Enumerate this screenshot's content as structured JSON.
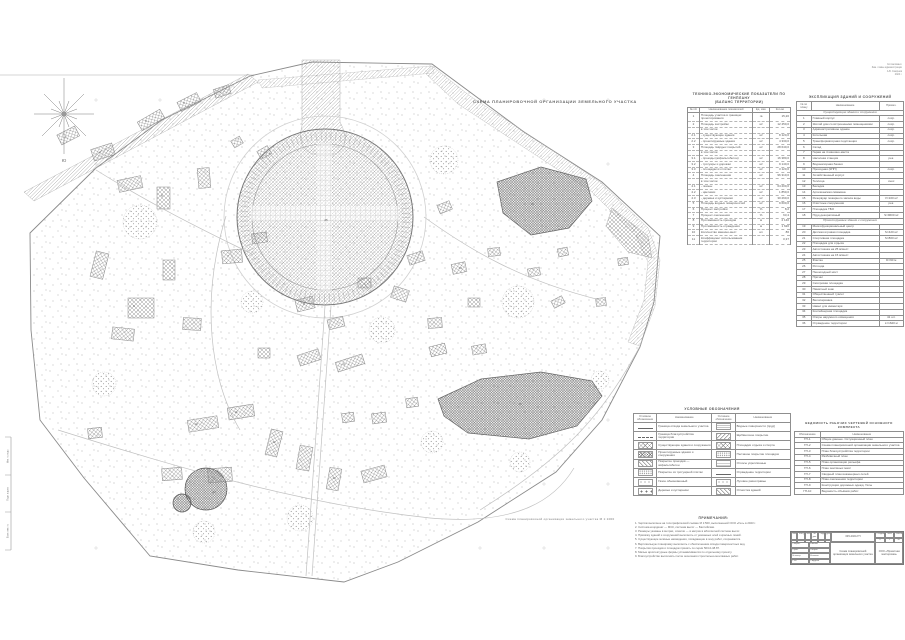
{
  "plan": {
    "title": "СХЕМА ПЛАНИРОВОЧНОЙ ОРГАНИЗАЦИИ ЗЕМЕЛЬНОГО УЧАСТКА",
    "caption": "Схема планировочной организации земельного участка  М 1:1000",
    "compass_south_label": "Ю",
    "corner_note_lines": [
      "Согласовано:",
      "Зам. главы администрации",
      "А.В. Смирнов",
      "2024 г."
    ],
    "labels": [
      {
        "x": 66,
        "y": 137,
        "t": "1"
      },
      {
        "x": 100,
        "y": 152,
        "t": "2"
      },
      {
        "x": 146,
        "y": 121,
        "t": "3"
      },
      {
        "x": 184,
        "y": 103,
        "t": "4"
      },
      {
        "x": 162,
        "y": 196,
        "t": "5"
      },
      {
        "x": 134,
        "y": 306,
        "t": "6"
      },
      {
        "x": 228,
        "y": 256,
        "t": "7"
      },
      {
        "x": 304,
        "y": 304,
        "t": "8"
      },
      {
        "x": 344,
        "y": 364,
        "t": "9"
      },
      {
        "x": 196,
        "y": 424,
        "t": "10"
      },
      {
        "x": 236,
        "y": 412,
        "t": "11"
      },
      {
        "x": 274,
        "y": 442,
        "t": "12"
      },
      {
        "x": 334,
        "y": 478,
        "t": "13"
      },
      {
        "x": 460,
        "y": 268,
        "t": "14"
      },
      {
        "x": 532,
        "y": 204,
        "t": "15"
      },
      {
        "x": 520,
        "y": 404,
        "t": "19"
      },
      {
        "x": 214,
        "y": 492,
        "t": "20"
      },
      {
        "x": 326,
        "y": 220,
        "t": "25"
      }
    ]
  },
  "tep_table": {
    "title_line1": "ТЕХНИКО-ЭКОНОМИЧЕСКИЕ ПОКАЗАТЕЛИ ПО ГЕНПЛАНУ",
    "title_line2": "(БАЛАНС ТЕРРИТОРИИ)",
    "columns": [
      "№ п/п",
      "Наименование показателей",
      "Ед. изм.",
      "Кол-во"
    ],
    "rows": [
      [
        "1",
        "Площадь участка в границах проектирования",
        "га",
        "15,20"
      ],
      [
        "2",
        "Площадь застройки",
        "м²",
        "12 450,0"
      ],
      [
        "",
        "в том числе:",
        "",
        ""
      ],
      [
        "2.1",
        "- существующие здания",
        "м²",
        "8 120,0"
      ],
      [
        "2.2",
        "- проектируемые здания",
        "м²",
        "4 330,0"
      ],
      [
        "3",
        "Площадь твёрдых покрытий",
        "м²",
        "28 640,0"
      ],
      [
        "",
        "в том числе:",
        "",
        ""
      ],
      [
        "3.1",
        "- проезды (асфальтобетон)",
        "м²",
        "16 380,0"
      ],
      [
        "3.2",
        "- тротуары и дорожки",
        "м²",
        "9 140,0"
      ],
      [
        "3.3",
        "- площадки из плитки",
        "м²",
        "3 120,0"
      ],
      [
        "4",
        "Площадь озеленения",
        "м²",
        "96 310,0"
      ],
      [
        "",
        "в том числе:",
        "",
        ""
      ],
      [
        "4.1",
        "- газоны",
        "м²",
        "64 200,0"
      ],
      [
        "4.2",
        "- цветники",
        "м²",
        "1 850,0"
      ],
      [
        "4.3",
        "- деревья и кустарники",
        "м²",
        "30 260,0"
      ],
      [
        "5",
        "Площадь водных поверхностей",
        "м²",
        "9 600,0"
      ],
      [
        "6",
        "Процент застройки",
        "%",
        "8,2"
      ],
      [
        "7",
        "Процент озеленения",
        "%",
        "63,4"
      ],
      [
        "8",
        "Протяжённость проездов",
        "м",
        "2 140"
      ],
      [
        "9",
        "Протяжённость ограждения",
        "м",
        "1 620"
      ],
      [
        "10",
        "Количество машино-мест",
        "шт.",
        "86"
      ],
      [
        "11",
        "Коэффициент использования территории",
        "",
        "0,37"
      ]
    ]
  },
  "explication_table": {
    "title": "ЭКСПЛИКАЦИЯ ЗДАНИЙ И СООРУЖЕНИЙ",
    "columns": [
      "№ по плану",
      "Наименование",
      "Примеч."
    ],
    "sections": [
      {
        "header": "Существующие здания и сооружения",
        "rows": [
          [
            "1",
            "Главный корпус",
            "сохр."
          ],
          [
            "2",
            "Жилой дом со встроенными помещениями",
            "сохр."
          ],
          [
            "3",
            "Административное здание",
            "сохр."
          ],
          [
            "4",
            "Котельная",
            "сохр."
          ],
          [
            "5",
            "Трансформаторная подстанция",
            "сохр."
          ],
          [
            "6",
            "Склад",
            ""
          ],
          [
            "7",
            "Гараж на 4 машино-места",
            ""
          ],
          [
            "8",
            "Насосная станция",
            "рек."
          ],
          [
            "9",
            "Водонапорная башня",
            ""
          ],
          [
            "10",
            "Проходная (КПП)",
            "сохр."
          ],
          [
            "11",
            "Хозяйственный корпус",
            ""
          ],
          [
            "12",
            "Теплица",
            "снос"
          ],
          [
            "13",
            "Беседка",
            ""
          ],
          [
            "14",
            "Артезианская скважина",
            ""
          ],
          [
            "15",
            "Резервуар пожарного запаса воды",
            "V=100 м³"
          ],
          [
            "16",
            "Очистные сооружения",
            "рек."
          ],
          [
            "17",
            "Площадка ТБО",
            ""
          ],
          [
            "18",
            "Пруд декоративный",
            "S=9600 м²"
          ]
        ]
      },
      {
        "header": "Проектируемые здания и сооружения",
        "rows": [
          [
            "19",
            "Многофункциональный центр",
            ""
          ],
          [
            "20",
            "Детская игровая площадка",
            "S=420 м²"
          ],
          [
            "21",
            "Спортивная площадка",
            "S=800 м²"
          ],
          [
            "22",
            "Площадка для отдыха",
            ""
          ],
          [
            "23",
            "Автостоянка на 25 м/мест",
            ""
          ],
          [
            "24",
            "Автостоянка на 15 м/мест",
            ""
          ],
          [
            "25",
            "Фонтан",
            "D=90 м"
          ],
          [
            "26",
            "Ротонда",
            ""
          ],
          [
            "27",
            "Пешеходный мост",
            ""
          ],
          [
            "28",
            "Причал",
            ""
          ],
          [
            "29",
            "Смотровая площадка",
            ""
          ],
          [
            "30",
            "Памятный знак",
            ""
          ],
          [
            "31",
            "Общественный туалет",
            ""
          ],
          [
            "32",
            "Велопарковка",
            ""
          ],
          [
            "33",
            "Навес для инвентаря",
            ""
          ],
          [
            "34",
            "Контейнерная площадка",
            ""
          ],
          [
            "35",
            "Опоры наружного освещения",
            "41 шт."
          ],
          [
            "36",
            "Ограждение территории",
            "L=1620 м"
          ]
        ]
      }
    ]
  },
  "legend": {
    "title": "УСЛОВНЫЕ ОБОЗНАЧЕНИЯ",
    "col_headers": [
      "Условное обозначение",
      "Наименование",
      "Условное обозначение",
      "Наименование"
    ],
    "rows": [
      {
        "lp": "line-solid",
        "ll": "Граница отвода земельного участка",
        "rp": "wave",
        "rl": "Водные поверхности (пруд)"
      },
      {
        "lp": "line-dashdot",
        "ll": "Граница благоустройства территории",
        "rp": "hatch-diag2",
        "rl": "Щебёночное покрытие"
      },
      {
        "lp": "hatch-cross",
        "ll": "Существующие здания и сооружения",
        "rp": "hatch-cross",
        "rl": "Площадки отдыха и спорта"
      },
      {
        "lp": "hatch-dense",
        "ll": "Проектируемые здания и сооружения",
        "rp": "dots-dense",
        "rl": "Песчаное покрытие площадок"
      },
      {
        "lp": "hatch-diag",
        "ll": "Покрытие проездов — асфальтобетон",
        "rp": "hlines",
        "rl": "Откосы укреплённые"
      },
      {
        "lp": "dots-dense",
        "ll": "Покрытие из тротуарной плитки",
        "rp": "line-fence",
        "rl": "Ограждение территории"
      },
      {
        "lp": "dots-sparse",
        "ll": "Газон обыкновенный",
        "rp": "dots-sparse",
        "rl": "Луговое разнотравье"
      },
      {
        "lp": "tree",
        "ll": "Деревья и кустарники",
        "rp": "hatch-diag",
        "rl": "Отмостка зданий"
      }
    ]
  },
  "sheets_table": {
    "title": "ВЕДОМОСТЬ РАБОЧИХ ЧЕРТЕЖЕЙ ОСНОВНОГО КОМПЛЕКТА",
    "columns": [
      "Обозначение",
      "Наименование"
    ],
    "rows": [
      [
        "ГП-1",
        "Общие данные. Ситуационный план"
      ],
      [
        "ГП-2",
        "Схема планировочной организации земельного участка"
      ],
      [
        "ГП-3",
        "План благоустройства территории"
      ],
      [
        "ГП-4",
        "Разбивочный план"
      ],
      [
        "ГП-5",
        "План организации рельефа"
      ],
      [
        "ГП-6",
        "План земляных масс"
      ],
      [
        "ГП-7",
        "Сводный план инженерных сетей"
      ],
      [
        "ГП-8",
        "План озеленения территории"
      ],
      [
        "ГП-9",
        "Конструкции дорожных одежд. Узлы"
      ],
      [
        "ГП-10",
        "Ведомость объёмов работ"
      ]
    ]
  },
  "notes": {
    "title": "ПРИМЕЧАНИЯ:",
    "lines": [
      "1. Чертёж выполнен на топографической съёмке М 1:500, выполненной ООО «Гео» в 2023 г.",
      "2. Система координат — МСК, система высот — Балтийская.",
      "3. Размеры указаны в метрах, отметки — в метрах в абсолютной системе высот.",
      "4. Привязку зданий и сооружений выполнять от указанных осей и красных линий.",
      "5. Существующие зелёные насаждения, попадающие в зону работ, сохраняются.",
      "6. Вертикальную планировку выполнять с обеспечением отвода поверхностных вод.",
      "7. Покрытия проездов и площадок принять по серии 503-0-48.87.",
      "8. Малые архитектурные формы устанавливаются по отдельному проекту.",
      "9. Благоустройство выполнять после окончания строительно-монтажных работ."
    ]
  },
  "title_block": {
    "doc_code": "045-2024-ГП",
    "rev_headers": [
      "Изм.",
      "Кол.уч.",
      "Лист",
      "№ док.",
      "Подп.",
      "Дата"
    ],
    "roles": [
      {
        "role": "Разраб.",
        "name": "Иванов"
      },
      {
        "role": "Пров.",
        "name": "Петров"
      },
      {
        "role": "Н.контр.",
        "name": "Козлова"
      },
      {
        "role": "ГИП",
        "name": "Сидоров"
      }
    ],
    "sheet_title": "Схема планировочной организации земельного участка",
    "stage_headers": [
      "Стадия",
      "Лист",
      "Листов"
    ],
    "stage_values": [
      "П",
      "2",
      "10"
    ],
    "org": "ООО «Проектная мастерская»"
  },
  "side_stamp": {
    "labels": [
      "Инв. № подл.",
      "Подп. и дата",
      "Взам. инв. №"
    ]
  },
  "colors": {
    "line": "#8f8f8f",
    "text": "#555555",
    "hatch": "#9a9a9a",
    "background": "#ffffff"
  }
}
